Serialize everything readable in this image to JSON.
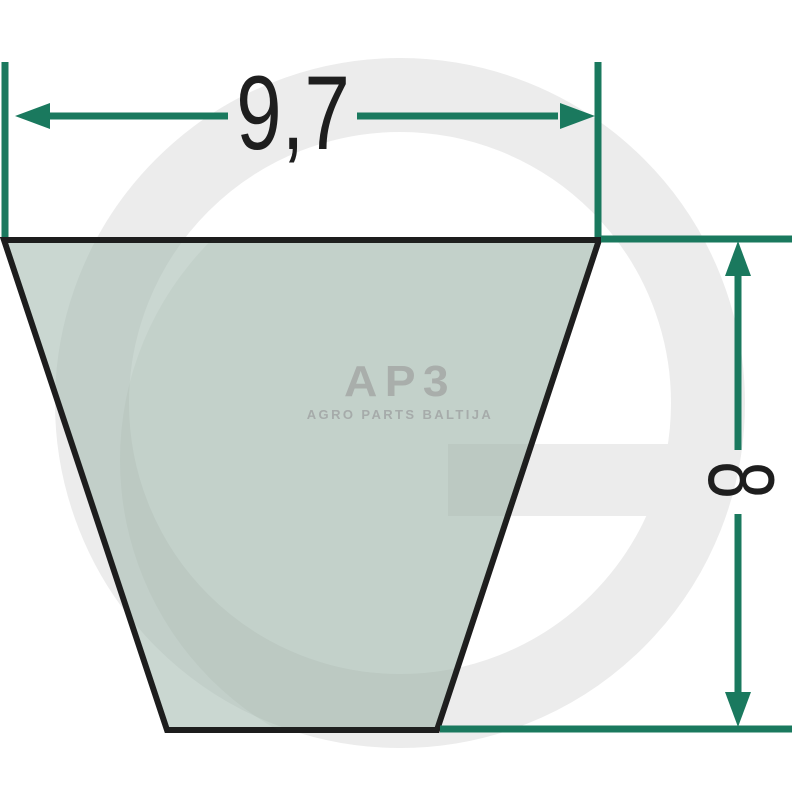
{
  "diagram": {
    "title": "V-belt cross-section dimensional drawing",
    "width_dimension": {
      "label": "9,7",
      "value": 9.7
    },
    "height_dimension": {
      "label": "8",
      "value": 8
    }
  },
  "logo": {
    "text": "AP3",
    "subtitle": "AGRO PARTS BALTIJA"
  },
  "watermark": {
    "letter": "G"
  },
  "colors": {
    "background": "#ffffff",
    "dimension_green": "#1a795e",
    "outline_black": "#1d1d1d",
    "belt_fill": "#cdd9d3",
    "watermark_gray": "#ececec",
    "logo_gray": "#a9aeab",
    "label_black": "#1e1e1e"
  }
}
